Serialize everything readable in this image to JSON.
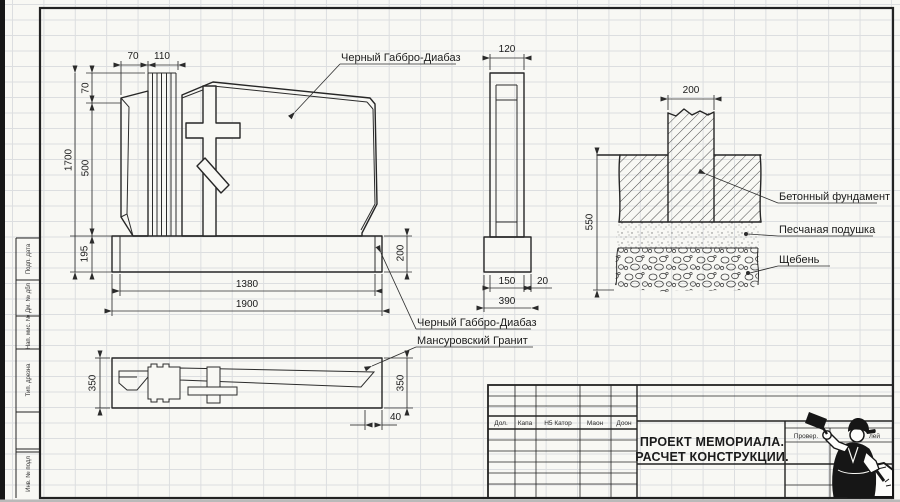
{
  "drawing": {
    "labels": {
      "gabbro_top": "Черный Габбро-Диабаз",
      "gabbro_bottom": "Черный Габбро-Диабаз",
      "granite": "Мансуровский Гранит",
      "concrete": "Бетонный фундамент",
      "sand": "Песчаная подушка",
      "gravel": "Щебень"
    },
    "front": {
      "dim_70_top": "70",
      "dim_110": "110",
      "dim_70_left": "70",
      "dim_1700": "1700",
      "dim_500": "500",
      "dim_195": "195",
      "dim_1380": "1380",
      "dim_1900": "1900",
      "dim_200_right": "200"
    },
    "side": {
      "dim_120": "120",
      "dim_150": "150",
      "dim_20": "20",
      "dim_390": "390"
    },
    "section": {
      "dim_200": "200",
      "dim_550": "550"
    },
    "plan": {
      "dim_350_left": "350",
      "dim_350_right": "350",
      "dim_40": "40"
    }
  },
  "title_block": {
    "project_line1": "ПРОЕКТ МЕМОРИАЛА.",
    "project_line2": "РАСЧЕТ КОНСТРУКЦИИ.",
    "columns": {
      "c1": "Дол.",
      "c2": "Капа",
      "c3": "Н5 Катор",
      "c4": "Маон",
      "c5": "Доон"
    },
    "checked": "Провер.",
    "partial": "лей"
  },
  "margin_column": {
    "c1": "Подп. дата",
    "c2": "Дм. № дбл",
    "c3": "Нап. мис. №",
    "c4": "Тип. дрезна",
    "c5": "Инв. № подл"
  }
}
